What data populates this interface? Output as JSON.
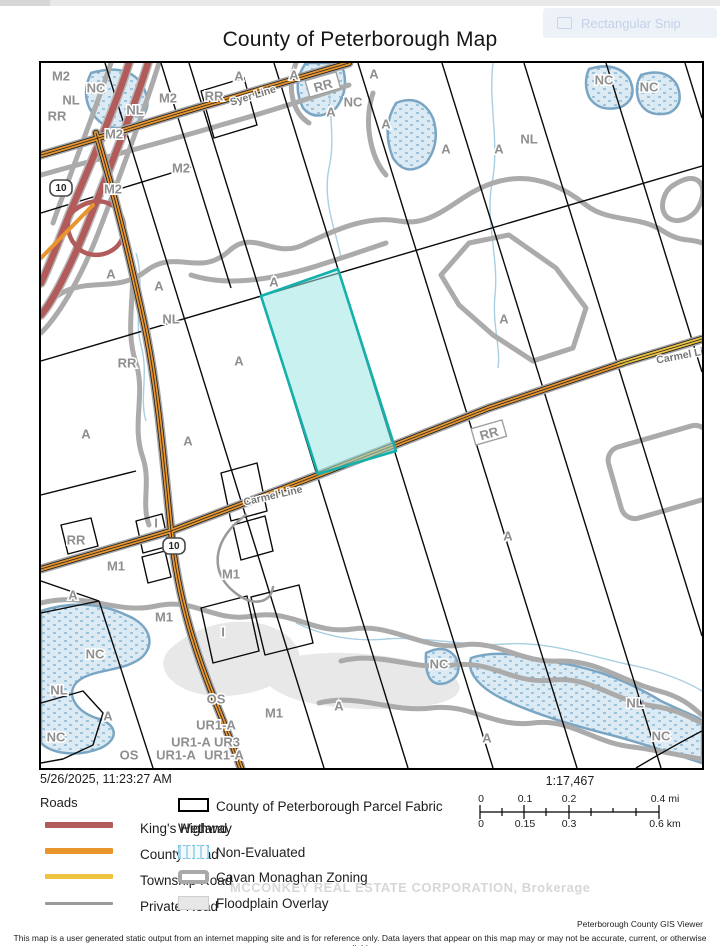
{
  "window": {
    "snip_tooltip_label": "Rectangular Snip"
  },
  "page": {
    "title": "County of Peterborough Map"
  },
  "map": {
    "highlight_fill": "#9ae5e2",
    "highlight_border": "#14b0ab",
    "zone_labels": [
      {
        "t": "M2",
        "x": 20,
        "y": 13
      },
      {
        "t": "NC",
        "x": 55,
        "y": 25
      },
      {
        "t": "NL",
        "x": 30,
        "y": 37
      },
      {
        "t": "RR",
        "x": 16,
        "y": 53
      },
      {
        "t": "M2",
        "x": 127,
        "y": 35
      },
      {
        "t": "RR",
        "x": 173,
        "y": 33
      },
      {
        "t": "NL",
        "x": 94,
        "y": 47
      },
      {
        "t": "M2",
        "x": 73,
        "y": 71
      },
      {
        "t": "M2",
        "x": 140,
        "y": 105
      },
      {
        "t": "M2",
        "x": 72,
        "y": 126
      },
      {
        "t": "A",
        "x": 198,
        "y": 13
      },
      {
        "t": "A",
        "x": 253,
        "y": 12
      },
      {
        "t": "A",
        "x": 333,
        "y": 11
      },
      {
        "t": "NC",
        "x": 312,
        "y": 39
      },
      {
        "t": "A",
        "x": 290,
        "y": 49
      },
      {
        "t": "A",
        "x": 345,
        "y": 61
      },
      {
        "t": "NC",
        "x": 563,
        "y": 17
      },
      {
        "t": "NC",
        "x": 608,
        "y": 24
      },
      {
        "t": "A",
        "x": 405,
        "y": 86
      },
      {
        "t": "A",
        "x": 458,
        "y": 86
      },
      {
        "t": "NL",
        "x": 488,
        "y": 76
      },
      {
        "t": "A",
        "x": 70,
        "y": 211
      },
      {
        "t": "A",
        "x": 118,
        "y": 223
      },
      {
        "t": "NL",
        "x": 130,
        "y": 256
      },
      {
        "t": "A",
        "x": 233,
        "y": 219
      },
      {
        "t": "RR",
        "x": 86,
        "y": 300
      },
      {
        "t": "A",
        "x": 198,
        "y": 298
      },
      {
        "t": "A",
        "x": 463,
        "y": 256
      },
      {
        "t": "A",
        "x": 45,
        "y": 371
      },
      {
        "t": "A",
        "x": 147,
        "y": 378
      },
      {
        "t": "A",
        "x": 467,
        "y": 473
      },
      {
        "t": "RR",
        "x": 35,
        "y": 477
      },
      {
        "t": "I",
        "x": 115,
        "y": 460
      },
      {
        "t": "M1",
        "x": 75,
        "y": 503
      },
      {
        "t": "M1",
        "x": 190,
        "y": 511
      },
      {
        "t": "A",
        "x": 32,
        "y": 532
      },
      {
        "t": "M1",
        "x": 123,
        "y": 554
      },
      {
        "t": "I",
        "x": 182,
        "y": 569
      },
      {
        "t": "NC",
        "x": 54,
        "y": 591
      },
      {
        "t": "NL",
        "x": 18,
        "y": 627
      },
      {
        "t": "A",
        "x": 67,
        "y": 653
      },
      {
        "t": "NC",
        "x": 15,
        "y": 674
      },
      {
        "t": "OS",
        "x": 175,
        "y": 636
      },
      {
        "t": "M1",
        "x": 233,
        "y": 650
      },
      {
        "t": "A",
        "x": 298,
        "y": 643
      },
      {
        "t": "UR1-A",
        "x": 175,
        "y": 662
      },
      {
        "t": "UR1-A",
        "x": 150,
        "y": 679
      },
      {
        "t": "UR3",
        "x": 186,
        "y": 679
      },
      {
        "t": "OS",
        "x": 88,
        "y": 692
      },
      {
        "t": "UR1-A",
        "x": 135,
        "y": 692
      },
      {
        "t": "UR1-A",
        "x": 183,
        "y": 692
      },
      {
        "t": "NC",
        "x": 398,
        "y": 601
      },
      {
        "t": "NL",
        "x": 594,
        "y": 640
      },
      {
        "t": "NC",
        "x": 620,
        "y": 673
      },
      {
        "t": "A",
        "x": 446,
        "y": 675
      }
    ],
    "road_names": [
      {
        "t": "Syer Line",
        "x": 212,
        "y": 33,
        "r": -17
      },
      {
        "t": "Carmel Line",
        "x": 645,
        "y": 292,
        "r": -11
      },
      {
        "t": "Carmel Line",
        "x": 232,
        "y": 433,
        "r": -13
      }
    ],
    "rr_plates": [
      {
        "t": "RR",
        "x": 282,
        "y": 22,
        "r": -16
      },
      {
        "t": "RR",
        "x": 448,
        "y": 370,
        "r": -16
      }
    ],
    "shields": [
      {
        "t": "10",
        "x": 20,
        "y": 125
      },
      {
        "t": "10",
        "x": 133,
        "y": 483
      }
    ]
  },
  "info": {
    "timestamp": "5/26/2025, 11:23:27 AM",
    "scale_ratio": "1:17,467",
    "scale_mi": [
      "0",
      "0.1",
      "0.2",
      "0.4 mi"
    ],
    "scale_km": [
      "0",
      "0.15",
      "0.3",
      "0.6 km"
    ]
  },
  "legend": {
    "roads_heading": "Roads",
    "road_items": [
      {
        "label": "King's Highway",
        "color": "#b25b5b"
      },
      {
        "label": "County Road",
        "color": "#e8952e"
      },
      {
        "label": "Township Road",
        "color": "#eec33f"
      },
      {
        "label": "Private Road",
        "color": "#9a9a9a"
      }
    ],
    "parcel_fabric_label": "County of Peterborough Parcel Fabric",
    "wetland_heading": "Wetland",
    "non_evaluated_label": "Non-Evaluated",
    "zoning_label": "Cavan Monaghan Zoning",
    "floodplain_label": "Floodplain Overlay"
  },
  "watermark": "MCCONKEY REAL ESTATE CORPORATION, Brokerage",
  "footer": {
    "credit": "Peterborough County GIS Viewer",
    "disclaimer": "This map is a user generated static output from an internet mapping site and is for reference only. Data layers that appear on this map may or may not be accurate, current, or otherwise reliable."
  }
}
